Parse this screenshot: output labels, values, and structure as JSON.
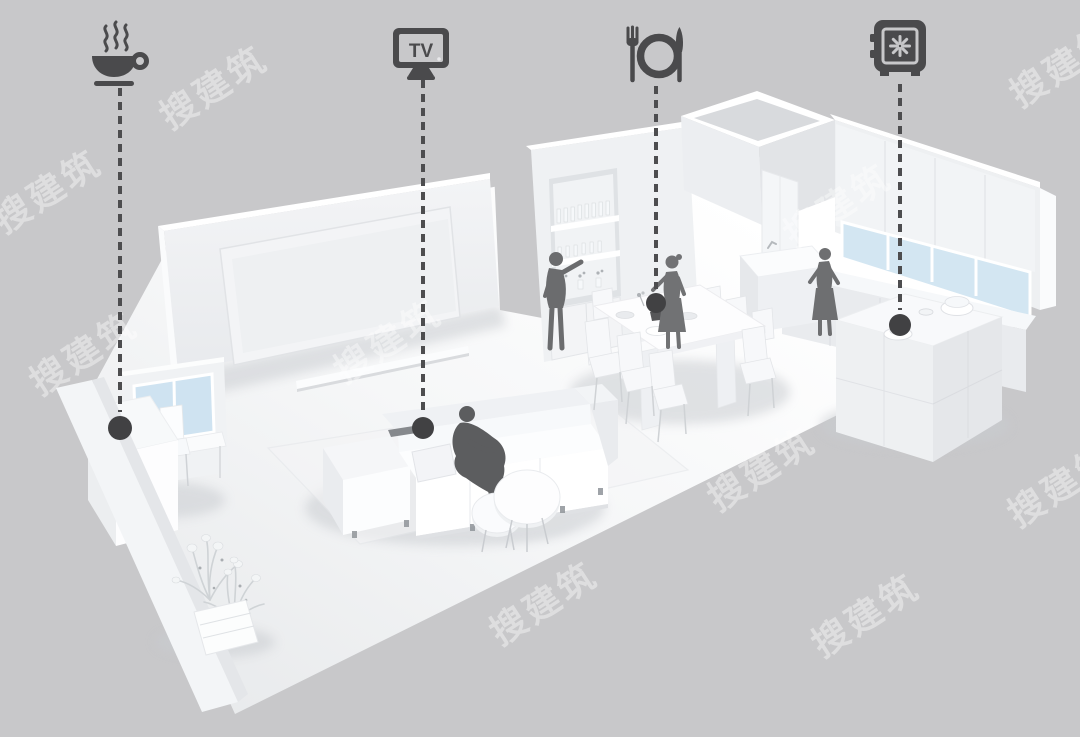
{
  "page": {
    "background_color": "#c8c8ca",
    "description": "Monochrome white 3D axonometric render of an open-plan apartment (coffee nook, living room with TV wall and sofa, dining room, kitchen) annotated with four icon callouts joined by vertical dashed leader lines ending in round dots"
  },
  "annotations": {
    "icon_color": "#4a4a4c",
    "dash_color": "#4d4d4f",
    "dot_color": "#414143",
    "markers": [
      {
        "id": "coffee",
        "icon": "coffee-cup-icon",
        "area": "coffee-bar-nook",
        "x": 120,
        "icon_top": 16,
        "line_top": 88,
        "line_bottom": 412,
        "dot_y": 428,
        "dot_r": 12
      },
      {
        "id": "tv",
        "icon": "tv-icon",
        "label": "TV",
        "area": "living-room-sofa",
        "x": 423,
        "icon_top": 16,
        "line_top": 80,
        "line_bottom": 413,
        "dot_y": 428,
        "dot_r": 11
      },
      {
        "id": "dining",
        "icon": "dining-place-setting-icon",
        "area": "dining-table",
        "x": 656,
        "icon_top": 18,
        "line_top": 86,
        "line_bottom": 289,
        "dot_y": 303,
        "dot_r": 10
      },
      {
        "id": "safe",
        "icon": "safe-icon",
        "area": "kitchen-counter",
        "x": 900,
        "icon_top": 12,
        "line_top": 84,
        "line_bottom": 310,
        "dot_y": 325,
        "dot_r": 11
      }
    ]
  },
  "watermark": {
    "text": "搜建筑",
    "color": "rgba(255,255,255,0.40)",
    "rotation_deg": -33,
    "font_size": 36,
    "positions": [
      [
        148,
        96
      ],
      [
        998,
        74
      ],
      [
        -18,
        200
      ],
      [
        18,
        362
      ],
      [
        322,
        350
      ],
      [
        772,
        214
      ],
      [
        696,
        478
      ],
      [
        996,
        494
      ],
      [
        478,
        612
      ],
      [
        800,
        624
      ]
    ]
  },
  "scene": {
    "style": "white monochrome architectural model",
    "rooms": [
      "coffee nook",
      "living room",
      "dining room",
      "kitchen"
    ],
    "people_count": 4,
    "people": [
      "man seated on sofa backrest",
      "man reaching wine shelf",
      "woman beside dining table",
      "woman at kitchen counter"
    ]
  }
}
